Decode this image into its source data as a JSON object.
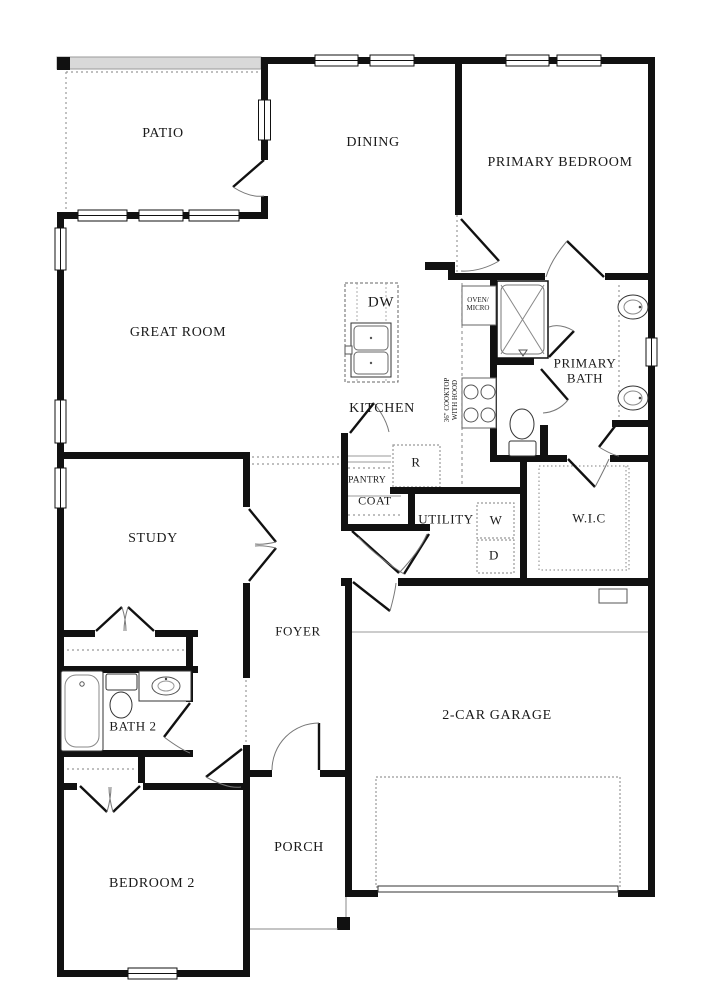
{
  "title": "single-story floor plan",
  "colors": {
    "wall": "#111111",
    "background": "#ffffff",
    "patio_screen_band": "#d9d9d9",
    "dashed_lines": "#888888",
    "door_arc": "#777777"
  },
  "rooms": [
    {
      "id": "patio",
      "label": "PATIO"
    },
    {
      "id": "dining",
      "label": "DINING"
    },
    {
      "id": "primary-bedroom",
      "label": "PRIMARY BEDROOM"
    },
    {
      "id": "great-room",
      "label": "GREAT ROOM"
    },
    {
      "id": "kitchen",
      "label": "KITCHEN"
    },
    {
      "id": "primary-bath",
      "label": "PRIMARY\nBATH"
    },
    {
      "id": "study",
      "label": "STUDY"
    },
    {
      "id": "wic",
      "label": "W.I.C"
    },
    {
      "id": "utility",
      "label": "UTILITY"
    },
    {
      "id": "pantry",
      "label": "PANTRY"
    },
    {
      "id": "coat",
      "label": "COAT"
    },
    {
      "id": "foyer",
      "label": "FOYER"
    },
    {
      "id": "bath-2",
      "label": "BATH 2"
    },
    {
      "id": "garage",
      "label": "2-CAR GARAGE"
    },
    {
      "id": "porch",
      "label": "PORCH"
    },
    {
      "id": "bedroom-2",
      "label": "BEDROOM 2"
    }
  ],
  "appliances": [
    {
      "id": "dishwasher",
      "label": "DW"
    },
    {
      "id": "oven-micro",
      "label": "OVEN/\nMICRO"
    },
    {
      "id": "cooktop-note",
      "label": "36\" COOKTOP\nWITH HOOD"
    },
    {
      "id": "refrigerator",
      "label": "R"
    },
    {
      "id": "washer",
      "label": "W"
    },
    {
      "id": "dryer",
      "label": "D"
    }
  ]
}
